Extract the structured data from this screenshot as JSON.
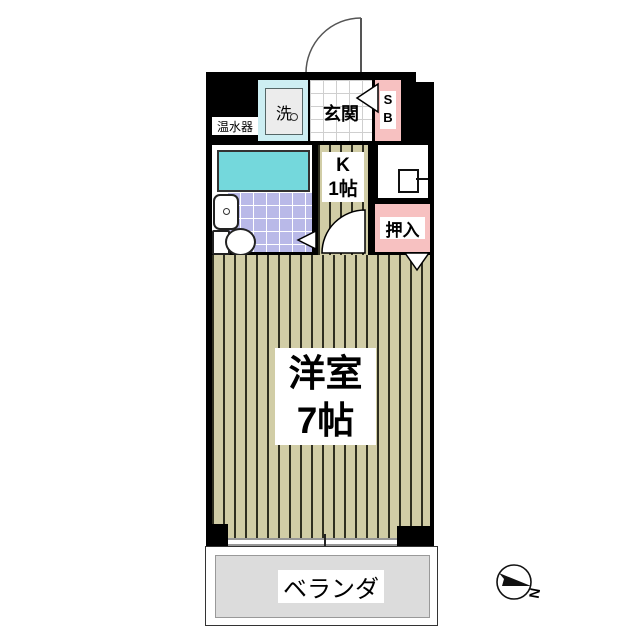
{
  "colors": {
    "wall": "#000000",
    "accent_pink": "#f7c1c1",
    "laundry_cyan": "#cdeef2",
    "bathtub_teal": "#74d8dc",
    "bath_tile": "#b9b9e8",
    "wood_floor": "#d1cda6",
    "wood_stripe": "#2f2f20",
    "balcony_gray": "#dcdcdc"
  },
  "labels": {
    "water_heater": "温水器",
    "laundry_machine": "洗",
    "entrance": "玄関",
    "shoe_box_line1": "S",
    "shoe_box_line2": "B",
    "kitchen_line1": "K",
    "kitchen_line2": "1帖",
    "closet": "押入",
    "main_room_line1": "洋室",
    "main_room_line2": "7帖",
    "balcony": "ベランダ",
    "compass_north": "N"
  },
  "icons": {
    "entrance_door": "quarter-circle-door-swing",
    "kitchen_door": "quarter-circle-door-swing",
    "washing_machine": "square-with-drain-circle",
    "bathtub": "bordered-rectangle",
    "toilet": "tank-and-bowl",
    "sink": "basin-with-drain",
    "stove_fixture": "square-with-pipe",
    "window": "double-line-sliding-window",
    "opening_arrows": "white-triangle-markers",
    "compass": "circle-with-north-arrow"
  }
}
